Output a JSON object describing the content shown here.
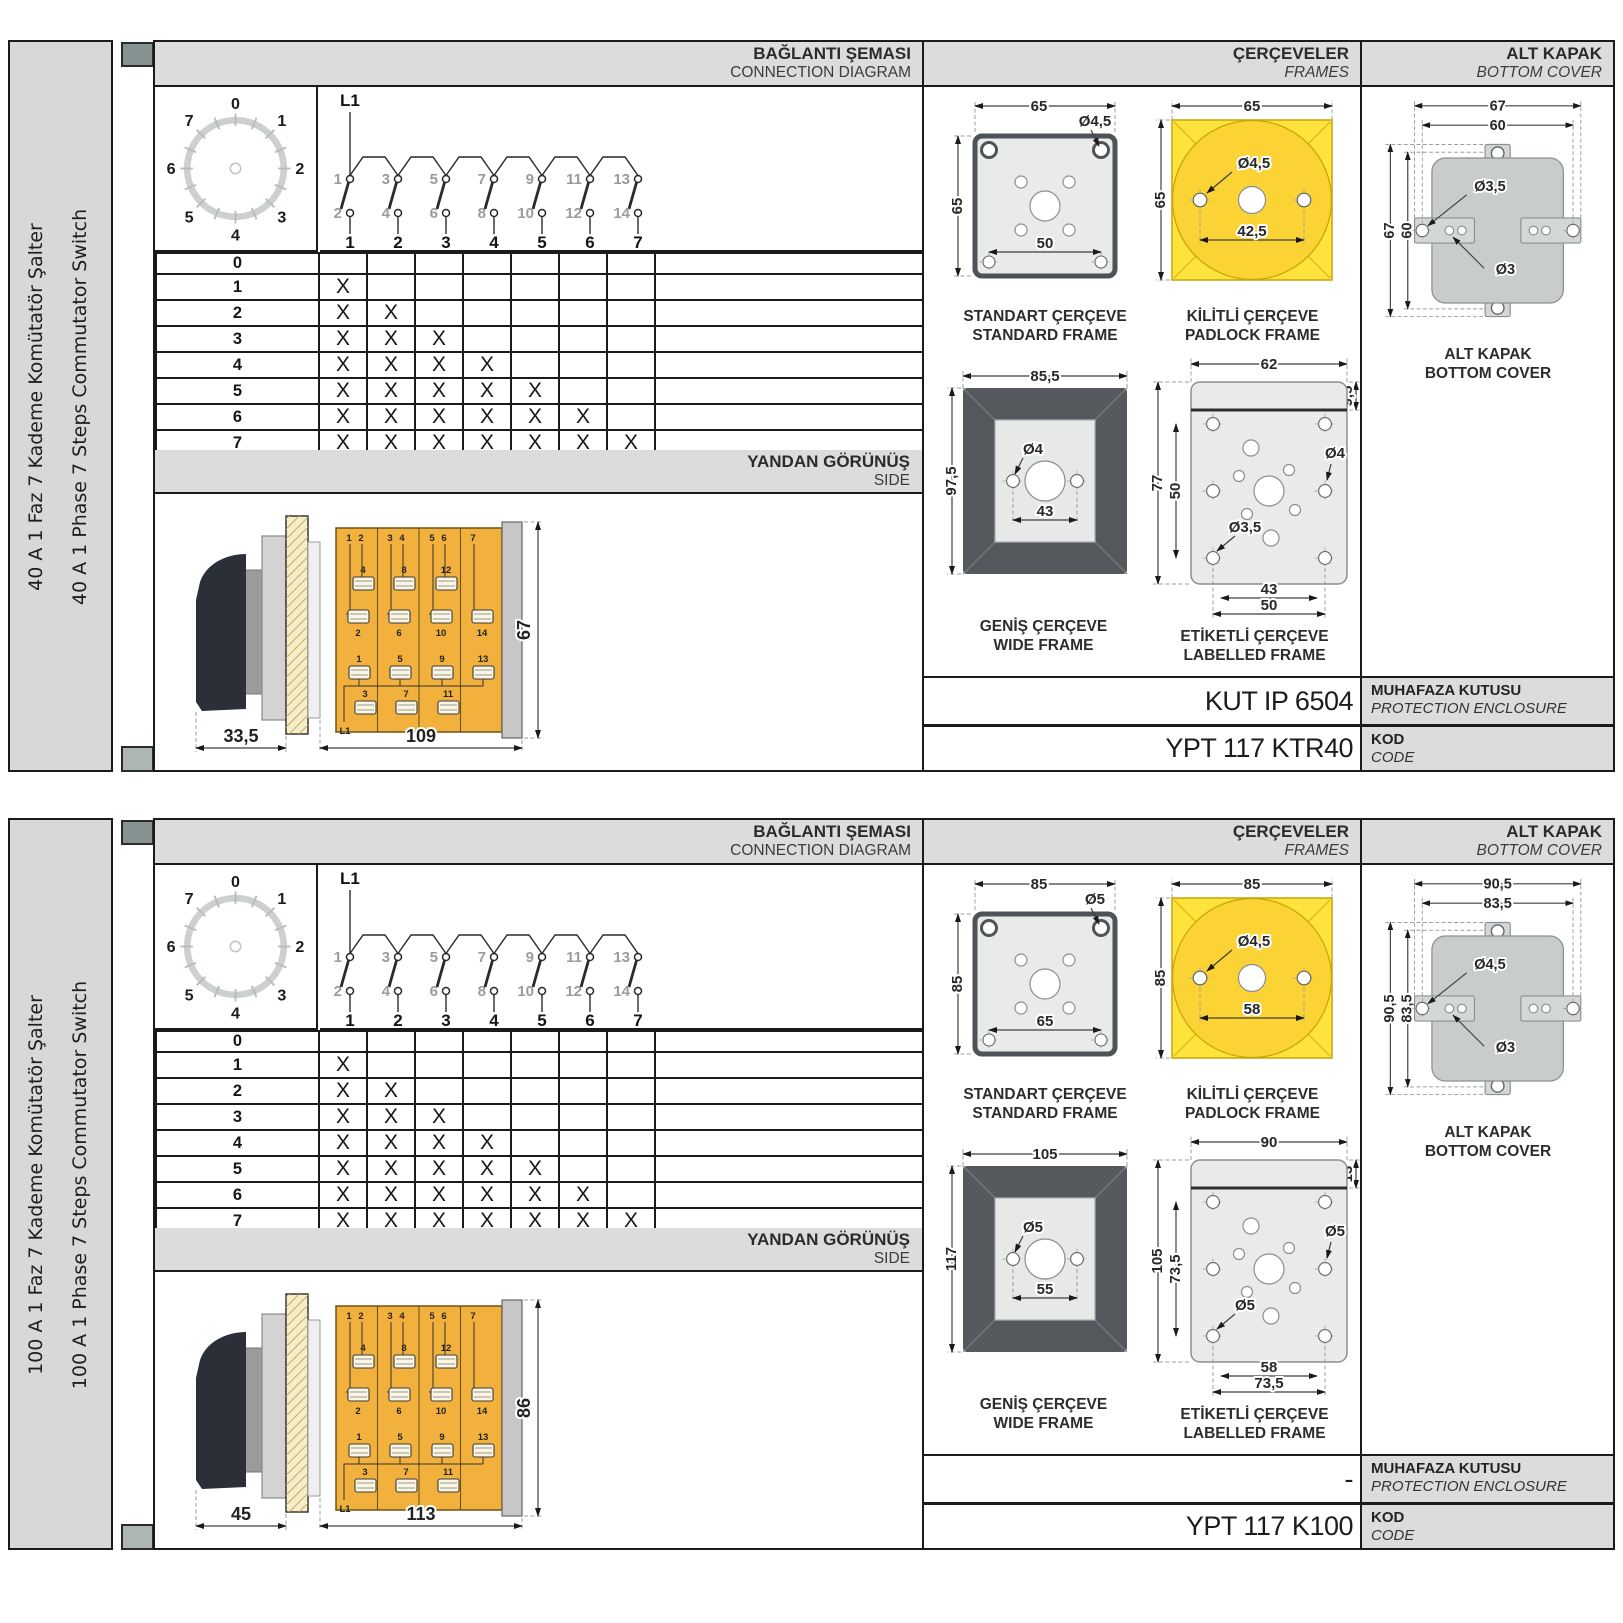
{
  "colors": {
    "band_gray": "#dcdcdc",
    "sidebar_gray": "#d7d8d8",
    "switch_body_orange": "#f2b13d",
    "padlock_yellow": "#ffe33d",
    "padlock_circle_yellow": "#fcd334",
    "wide_frame_gray": "#55595d",
    "cover_gray": "#c9cccc",
    "line_black": "#1a1a1a"
  },
  "panels": [
    {
      "sidebar": {
        "title_tr": "40 A 1 Faz 7 Kademe Komütatör Şalter",
        "title_en": "40 A 1 Phase 7 Steps Commutator Switch"
      },
      "connection": {
        "header_tr": "BAĞLANTI ŞEMASI",
        "header_en": "CONNECTION DIAGRAM",
        "dial": {
          "positions": [
            "0",
            "1",
            "2",
            "3",
            "4",
            "5",
            "6",
            "7"
          ]
        },
        "circuit": {
          "feed": "L1",
          "top_contacts": [
            "1",
            "3",
            "5",
            "7",
            "9",
            "11",
            "13"
          ],
          "bottom_contacts": [
            "2",
            "4",
            "6",
            "8",
            "10",
            "12",
            "14"
          ],
          "switches": [
            "1",
            "2",
            "3",
            "4",
            "5",
            "6",
            "7"
          ]
        },
        "table": {
          "rows": [
            {
              "label": "0",
              "marks": [
                "",
                "",
                "",
                "",
                "",
                "",
                ""
              ]
            },
            {
              "label": "1",
              "marks": [
                "X",
                "",
                "",
                "",
                "",
                "",
                ""
              ]
            },
            {
              "label": "2",
              "marks": [
                "X",
                "X",
                "",
                "",
                "",
                "",
                ""
              ]
            },
            {
              "label": "3",
              "marks": [
                "X",
                "X",
                "X",
                "",
                "",
                "",
                ""
              ]
            },
            {
              "label": "4",
              "marks": [
                "X",
                "X",
                "X",
                "X",
                "",
                "",
                ""
              ]
            },
            {
              "label": "5",
              "marks": [
                "X",
                "X",
                "X",
                "X",
                "X",
                "",
                ""
              ]
            },
            {
              "label": "6",
              "marks": [
                "X",
                "X",
                "X",
                "X",
                "X",
                "X",
                ""
              ]
            },
            {
              "label": "7",
              "marks": [
                "X",
                "X",
                "X",
                "X",
                "X",
                "X",
                "X"
              ]
            }
          ]
        }
      },
      "side_view": {
        "header_tr": "YANDAN GÖRÜNÜŞ",
        "header_en": "SIDE",
        "dim_knob": "33,5",
        "dim_body": "109",
        "dim_height": "67",
        "feed": "L1",
        "top_pins": [
          "1",
          "2",
          "3",
          "4",
          "5",
          "6",
          "7"
        ],
        "upper_terminals": [
          "4",
          "8",
          "12"
        ],
        "lower_terminals": [
          "2",
          "6",
          "10",
          "14"
        ],
        "mid_terminals": [
          "1",
          "5",
          "9",
          "13"
        ],
        "bottom_terminals": [
          "3",
          "7",
          "11"
        ]
      },
      "frames": {
        "header_tr": "ÇERÇEVELER",
        "header_en": "FRAMES",
        "standard": {
          "caption_tr": "STANDART ÇERÇEVE",
          "caption_en": "STANDARD FRAME",
          "width": "65",
          "height": "65",
          "hole": "Ø4,5",
          "span": "50"
        },
        "padlock": {
          "caption_tr": "KİLİTLİ ÇERÇEVE",
          "caption_en": "PADLOCK FRAME",
          "width": "65",
          "height": "65",
          "hole": "Ø4,5",
          "span": "42,5"
        },
        "wide": {
          "caption_tr": "GENİŞ ÇERÇEVE",
          "caption_en": "WIDE FRAME",
          "width": "85,5",
          "height": "97,5",
          "hole": "Ø4",
          "span": "43"
        },
        "labelled": {
          "caption_tr": "ETİKETLİ ÇERÇEVE",
          "caption_en": "LABELLED FRAME",
          "width": "62",
          "height": "77",
          "inner_height": "50",
          "head": "9,5",
          "hole_right": "Ø4",
          "hole_left": "Ø3,5",
          "span1": "43",
          "span2": "50"
        }
      },
      "cover": {
        "header_tr": "ALT KAPAK",
        "header_en": "BOTTOM COVER",
        "caption_tr": "ALT KAPAK",
        "caption_en": "BOTTOM COVER",
        "dim_outer_w": "67",
        "dim_inner_w": "60",
        "dim_outer_h": "67",
        "dim_inner_h": "60",
        "hole_big": "Ø3,5",
        "hole_small": "Ø3"
      },
      "codes": {
        "enclosure_value": "KUT IP 6504",
        "enclosure_tr": "MUHAFAZA KUTUSU",
        "enclosure_en": "PROTECTION ENCLOSURE",
        "code_value": "YPT 117 KTR40",
        "code_tr": "KOD",
        "code_en": "CODE"
      }
    },
    {
      "sidebar": {
        "title_tr": "100 A 1 Faz 7 Kademe Komütatör Şalter",
        "title_en": "100 A 1 Phase 7 Steps Commutator Switch"
      },
      "connection": {
        "header_tr": "BAĞLANTI ŞEMASI",
        "header_en": "CONNECTION DIAGRAM",
        "dial": {
          "positions": [
            "0",
            "1",
            "2",
            "3",
            "4",
            "5",
            "6",
            "7"
          ]
        },
        "circuit": {
          "feed": "L1",
          "top_contacts": [
            "1",
            "3",
            "5",
            "7",
            "9",
            "11",
            "13"
          ],
          "bottom_contacts": [
            "2",
            "4",
            "6",
            "8",
            "10",
            "12",
            "14"
          ],
          "switches": [
            "1",
            "2",
            "3",
            "4",
            "5",
            "6",
            "7"
          ]
        },
        "table": {
          "rows": [
            {
              "label": "0",
              "marks": [
                "",
                "",
                "",
                "",
                "",
                "",
                ""
              ]
            },
            {
              "label": "1",
              "marks": [
                "X",
                "",
                "",
                "",
                "",
                "",
                ""
              ]
            },
            {
              "label": "2",
              "marks": [
                "X",
                "X",
                "",
                "",
                "",
                "",
                ""
              ]
            },
            {
              "label": "3",
              "marks": [
                "X",
                "X",
                "X",
                "",
                "",
                "",
                ""
              ]
            },
            {
              "label": "4",
              "marks": [
                "X",
                "X",
                "X",
                "X",
                "",
                "",
                ""
              ]
            },
            {
              "label": "5",
              "marks": [
                "X",
                "X",
                "X",
                "X",
                "X",
                "",
                ""
              ]
            },
            {
              "label": "6",
              "marks": [
                "X",
                "X",
                "X",
                "X",
                "X",
                "X",
                ""
              ]
            },
            {
              "label": "7",
              "marks": [
                "X",
                "X",
                "X",
                "X",
                "X",
                "X",
                "X"
              ]
            }
          ]
        }
      },
      "side_view": {
        "header_tr": "YANDAN GÖRÜNÜŞ",
        "header_en": "SIDE",
        "dim_knob": "45",
        "dim_body": "113",
        "dim_height": "86",
        "feed": "L1",
        "top_pins": [
          "1",
          "2",
          "3",
          "4",
          "5",
          "6",
          "7"
        ],
        "upper_terminals": [
          "4",
          "8",
          "12"
        ],
        "lower_terminals": [
          "2",
          "6",
          "10",
          "14"
        ],
        "mid_terminals": [
          "1",
          "5",
          "9",
          "13"
        ],
        "bottom_terminals": [
          "3",
          "7",
          "11"
        ]
      },
      "frames": {
        "header_tr": "ÇERÇEVELER",
        "header_en": "FRAMES",
        "standard": {
          "caption_tr": "STANDART ÇERÇEVE",
          "caption_en": "STANDARD FRAME",
          "width": "85",
          "height": "85",
          "hole": "Ø5",
          "span": "65"
        },
        "padlock": {
          "caption_tr": "KİLİTLİ ÇERÇEVE",
          "caption_en": "PADLOCK FRAME",
          "width": "85",
          "height": "85",
          "hole": "Ø4,5",
          "span": "58"
        },
        "wide": {
          "caption_tr": "GENİŞ ÇERÇEVE",
          "caption_en": "WIDE FRAME",
          "width": "105",
          "height": "117",
          "hole": "Ø5",
          "span": "55"
        },
        "labelled": {
          "caption_tr": "ETİKETLİ ÇERÇEVE",
          "caption_en": "LABELLED FRAME",
          "width": "90",
          "height": "105",
          "inner_height": "73,5",
          "head": "13",
          "hole_right": "Ø5",
          "hole_left": "Ø5",
          "span1": "58",
          "span2": "73,5"
        }
      },
      "cover": {
        "header_tr": "ALT KAPAK",
        "header_en": "BOTTOM COVER",
        "caption_tr": "ALT KAPAK",
        "caption_en": "BOTTOM COVER",
        "dim_outer_w": "90,5",
        "dim_inner_w": "83,5",
        "dim_outer_h": "90,5",
        "dim_inner_h": "83,5",
        "hole_big": "Ø4,5",
        "hole_small": "Ø3"
      },
      "codes": {
        "enclosure_value": "-",
        "enclosure_tr": "MUHAFAZA KUTUSU",
        "enclosure_en": "PROTECTION ENCLOSURE",
        "code_value": "YPT 117 K100",
        "code_tr": "KOD",
        "code_en": "CODE"
      }
    }
  ]
}
